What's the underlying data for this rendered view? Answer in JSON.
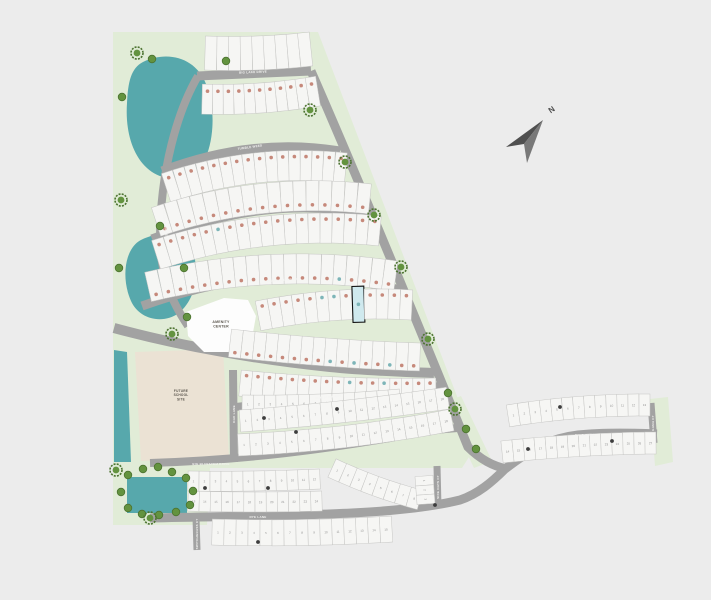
{
  "canvas": {
    "width": 711,
    "height": 600,
    "background": "#ececec"
  },
  "palette": {
    "grass": "#e1ecd7",
    "pond": "#57a8ac",
    "street": "#a2a2a2",
    "lot_fill": "#f6f6f4",
    "lot_stroke": "#c6c6c4",
    "dot_sold": "#c6897b",
    "dot_available": "#7db5b8",
    "highlight_fill": "#cfe9ee",
    "highlight_stroke": "#111111",
    "tree": "#63933f",
    "tree_ring": "#4c7330",
    "future_site": "#ebe2d4",
    "amenity": "#fdfdfd",
    "compass_dark": "#4f4f4f",
    "compass_light": "#787878",
    "lot_number_color": "#8f8f8f",
    "marker": "#3d3d3d"
  },
  "compass": {
    "north_label": "N"
  },
  "sites": {
    "amenity": {
      "lines": [
        "AMENITY",
        "CENTER"
      ],
      "poly": "186,312 224,298 248,300 256,316 252,338 234,352 204,352 188,336",
      "lx": 221,
      "ly": 323
    },
    "future": {
      "lines": [
        "FUTURE",
        "SCHOOL",
        "SITE"
      ],
      "poly": "135,352 223,349 229,457 141,461",
      "lx": 181,
      "ly": 392
    }
  },
  "greens": [
    "113,32 318,32 476,446 462,468 210,468 207,525 113,525",
    "443,403 461,396 492,461 474,468",
    "650,399 668,397 673,462 655,466"
  ],
  "ponds": {
    "blobs": [
      "M143,62 C168,50 196,58 206,84 C216,108 214,142 204,161 C194,179 168,183 152,172 C133,159 125,132 127,103 C128,82 131,68 143,62 Z",
      "M151,236 C172,229 191,240 195,260 C199,281 193,301 179,313 C162,325 139,319 131,301 C123,283 124,262 131,250 C137,240 143,239 151,236 Z"
    ],
    "polys": [
      "114,350 127,352 131,462 114,462",
      "127,477 187,477 187,513 127,513"
    ]
  },
  "streets": [
    {
      "name": "BIG LAKE DRIVE",
      "d": "M197,76 L311,71",
      "w": 9,
      "lx": 253,
      "ly": 72,
      "lr": -2
    },
    {
      "name": "",
      "d": "M311,71 C350,160 400,280 468,447 C480,459 492,466 507,469",
      "w": 9,
      "lx": 0,
      "ly": 0,
      "lr": 0
    },
    {
      "name": "TUMBLE WEED",
      "d": "M162,171 C220,149 280,141 340,151",
      "w": 9,
      "lx": 250,
      "ly": 147,
      "lr": -8
    },
    {
      "name": "COTTONWOOD WAY",
      "d": "M152,239 C230,209 300,200 374,215",
      "w": 9,
      "lx": 253,
      "ly": 213,
      "lr": -7
    },
    {
      "name": "IRONWOOD DRIVE",
      "d": "M142,306 C220,278 300,264 404,291",
      "w": 9,
      "lx": 282,
      "ly": 280,
      "lr": -4
    },
    {
      "name": "POLO WAY",
      "d": "M114,328 C180,346 260,360 330,367 C370,371 405,372 434,373",
      "w": 10,
      "lx": 262,
      "ly": 359,
      "lr": 4
    },
    {
      "name": "LAKESIDE DRIVE",
      "d": "M198,76 C178,110 160,170 160,240 C161,278 172,302 188,326",
      "w": 8,
      "lx": 165,
      "ly": 222,
      "lr": 83
    },
    {
      "name": "BLUESTEM WAY",
      "d": "M235,407 C300,400 360,390 442,386",
      "w": 8,
      "lx": 328,
      "ly": 397,
      "lr": -5
    },
    {
      "name": "BIG BLUESTEM DRIVE",
      "d": "M150,463 C250,460 330,448 390,438 C415,433 440,429 458,428",
      "w": 8,
      "lx": 211,
      "ly": 464,
      "lr": 0
    },
    {
      "name": "RYE LANE",
      "d": "M150,518 C270,515 392,517 460,500 C478,494 492,482 505,469",
      "w": 9,
      "lx": 258,
      "ly": 517,
      "lr": 0
    },
    {
      "name": "PALO DURO",
      "d": "M505,469 C532,448 552,438 578,435 C605,432 635,433 657,434",
      "w": 9,
      "lx": 585,
      "ly": 435,
      "lr": -1
    },
    {
      "name": "OAK LANE",
      "d": "M233,370 L234,462",
      "w": 8,
      "lx": 234,
      "ly": 414,
      "lr": -90
    },
    {
      "name": "SWITCHGRASS CT",
      "d": "M196,518 L197,550",
      "w": 7,
      "lx": 197,
      "ly": 534,
      "lr": -90
    },
    {
      "name": "SIDE OATS CT",
      "d": "M437,466 L438,507",
      "w": 7,
      "lx": 438,
      "ly": 487,
      "lr": -90
    },
    {
      "name": "GAMA CT",
      "d": "M651,403 L654,443",
      "w": 7,
      "lx": 653,
      "ly": 423,
      "lr": -90
    }
  ],
  "lot_rows": [
    {
      "x1": 205,
      "y1": 53,
      "x2": 311,
      "y2": 49,
      "bend": 2,
      "n": 9,
      "h": 34,
      "type": "plain"
    },
    {
      "x1": 202,
      "y1": 99,
      "x2": 318,
      "y2": 91,
      "bend": 3,
      "n": 11,
      "h": 30,
      "type": "dots",
      "dot": -8,
      "teal": []
    },
    {
      "x1": 166,
      "y1": 188,
      "x2": 346,
      "y2": 168,
      "bend": -10,
      "n": 16,
      "h": 30,
      "type": "dots",
      "dot": -9,
      "teal": []
    },
    {
      "x1": 156,
      "y1": 222,
      "x2": 370,
      "y2": 199,
      "bend": -12,
      "n": 17,
      "h": 30,
      "type": "dots",
      "dot": 9,
      "teal": []
    },
    {
      "x1": 156,
      "y1": 255,
      "x2": 380,
      "y2": 231,
      "bend": -12,
      "n": 19,
      "h": 30,
      "type": "dots",
      "dot": -9,
      "teal": [
        5
      ]
    },
    {
      "x1": 148,
      "y1": 287,
      "x2": 396,
      "y2": 276,
      "bend": -12,
      "n": 20,
      "h": 30,
      "type": "dots",
      "dot": 9,
      "teal": [
        15
      ]
    },
    {
      "x1": 258,
      "y1": 316,
      "x2": 412,
      "y2": 305,
      "bend": -5,
      "n": 13,
      "h": 30,
      "type": "dots",
      "dot": -9,
      "teal": [
        5,
        6
      ],
      "hl": 8
    },
    {
      "x1": 230,
      "y1": 343,
      "x2": 420,
      "y2": 357,
      "bend": 2,
      "n": 16,
      "h": 28,
      "type": "dots",
      "dot": 9,
      "teal": [
        8,
        10,
        13
      ]
    },
    {
      "x1": 240,
      "y1": 383,
      "x2": 436,
      "y2": 391,
      "bend": 3,
      "n": 17,
      "h": 26,
      "type": "dots",
      "dot": -8,
      "teal": [
        9,
        12
      ]
    },
    {
      "x1": 242,
      "y1": 404,
      "x2": 400,
      "y2": 398,
      "bend": 2,
      "n": 14,
      "h": 18,
      "type": "nums",
      "start": 1
    },
    {
      "x1": 240,
      "y1": 421,
      "x2": 448,
      "y2": 398,
      "bend": 2,
      "n": 18,
      "h": 22,
      "type": "nums",
      "start": 1
    },
    {
      "x1": 238,
      "y1": 445,
      "x2": 452,
      "y2": 420,
      "bend": 4,
      "n": 18,
      "h": 22,
      "type": "nums",
      "start": 1
    },
    {
      "x1": 188,
      "y1": 481,
      "x2": 320,
      "y2": 479,
      "bend": 1,
      "n": 12,
      "h": 20,
      "type": "nums",
      "start": 1
    },
    {
      "x1": 188,
      "y1": 501,
      "x2": 322,
      "y2": 501,
      "bend": 1,
      "n": 12,
      "h": 20,
      "type": "nums",
      "start": 13
    },
    {
      "x1": 332,
      "y1": 468,
      "x2": 420,
      "y2": 500,
      "bend": 2,
      "n": 8,
      "h": 20,
      "type": "nums",
      "start": 1
    },
    {
      "x1": 424,
      "y1": 476,
      "x2": 426,
      "y2": 504,
      "bend": 0,
      "n": 3,
      "h": 18,
      "type": "nums",
      "start": 1
    },
    {
      "x1": 212,
      "y1": 532,
      "x2": 392,
      "y2": 529,
      "bend": 2,
      "n": 15,
      "h": 26,
      "type": "nums",
      "start": 1
    },
    {
      "x1": 508,
      "y1": 416,
      "x2": 650,
      "y2": 405,
      "bend": -3,
      "n": 13,
      "h": 22,
      "type": "nums",
      "start": 1
    },
    {
      "x1": 502,
      "y1": 452,
      "x2": 656,
      "y2": 443,
      "bend": -2,
      "n": 14,
      "h": 22,
      "type": "nums",
      "start": 14
    }
  ],
  "trees": [
    [
      137,
      53,
      "b"
    ],
    [
      152,
      59,
      "s"
    ],
    [
      122,
      97,
      "s"
    ],
    [
      226,
      61,
      "s"
    ],
    [
      310,
      110,
      "b"
    ],
    [
      121,
      200,
      "b"
    ],
    [
      160,
      226,
      "s"
    ],
    [
      119,
      268,
      "s"
    ],
    [
      184,
      268,
      "s"
    ],
    [
      187,
      317,
      "s"
    ],
    [
      172,
      334,
      "b"
    ],
    [
      345,
      162,
      "b"
    ],
    [
      374,
      215,
      "b"
    ],
    [
      401,
      267,
      "b"
    ],
    [
      428,
      339,
      "b"
    ],
    [
      448,
      393,
      "s"
    ],
    [
      455,
      409,
      "b"
    ],
    [
      466,
      429,
      "s"
    ],
    [
      476,
      449,
      "s"
    ],
    [
      116,
      470,
      "b"
    ],
    [
      128,
      475,
      "s"
    ],
    [
      143,
      469,
      "s"
    ],
    [
      158,
      467,
      "s"
    ],
    [
      172,
      472,
      "s"
    ],
    [
      186,
      478,
      "s"
    ],
    [
      193,
      491,
      "s"
    ],
    [
      190,
      505,
      "s"
    ],
    [
      176,
      512,
      "s"
    ],
    [
      159,
      515,
      "s"
    ],
    [
      142,
      514,
      "s"
    ],
    [
      128,
      508,
      "s"
    ],
    [
      121,
      492,
      "s"
    ],
    [
      150,
      518,
      "b"
    ]
  ],
  "markers": [
    [
      264,
      418
    ],
    [
      337,
      409
    ],
    [
      528,
      449
    ],
    [
      560,
      407
    ],
    [
      612,
      441
    ],
    [
      435,
      505
    ],
    [
      258,
      542
    ],
    [
      205,
      488
    ],
    [
      268,
      488
    ],
    [
      296,
      432
    ]
  ]
}
